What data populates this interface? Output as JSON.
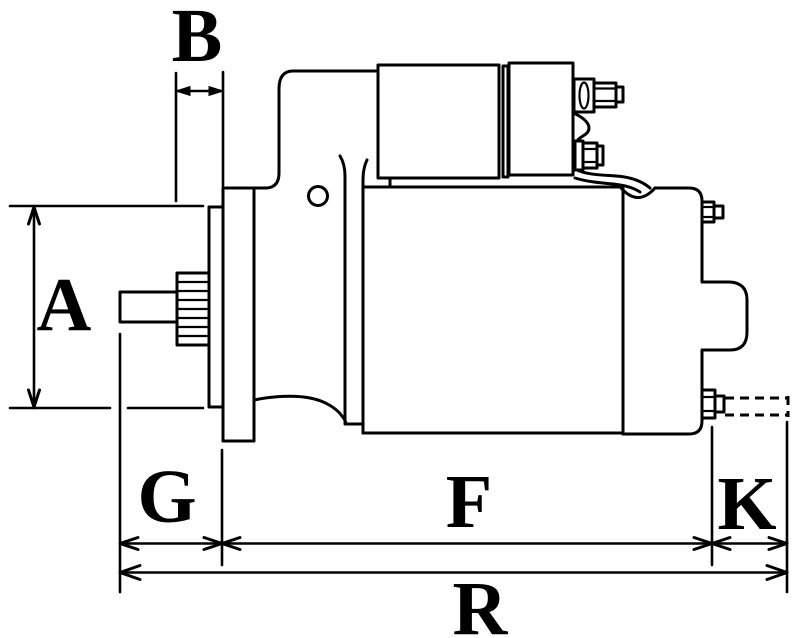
{
  "diagram": {
    "type": "technical-dimension-drawing",
    "subject": "starter motor side view with dimension callouts",
    "background_color": "#ffffff",
    "line_color": "#000000",
    "dimension_labels": {
      "A": "A",
      "B": "B",
      "G": "G",
      "F": "F",
      "K": "K",
      "R": "R"
    }
  }
}
